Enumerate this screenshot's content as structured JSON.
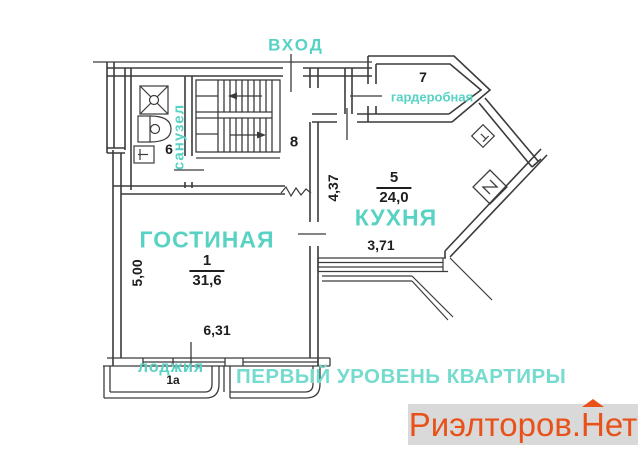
{
  "plan": {
    "entrance_label": "ВХОД",
    "subtitle": "ПЕРВЫЙ УРОВЕНЬ КВАРТИРЫ",
    "rooms": {
      "bathroom": {
        "label": "санузел",
        "number": "6"
      },
      "wardrobe": {
        "label": "гардеробная",
        "number": "7"
      },
      "hallway": {
        "number": "8"
      },
      "kitchen": {
        "label": "КУХНЯ",
        "number": "5",
        "area": "24,0"
      },
      "living_room": {
        "label": "ГОСТИНАЯ",
        "number": "1",
        "area": "31,6"
      },
      "loggia": {
        "label": "лоджия",
        "number": "1а"
      }
    },
    "dimensions": {
      "living_room_width": "6,31",
      "living_room_depth": "5,00",
      "kitchen_depth": "4,37",
      "kitchen_width": "3,71"
    }
  },
  "watermark": {
    "text_before_house": "Риэлторов.",
    "house_letter": "Н",
    "text_after_house": "ет"
  },
  "colors": {
    "accent_teal": "#57d2c3",
    "subtitle_teal": "#74dbce",
    "line_color": "#3b3b3b",
    "watermark_orange": "#e8521a",
    "watermark_bg": "#d9d9d9"
  }
}
